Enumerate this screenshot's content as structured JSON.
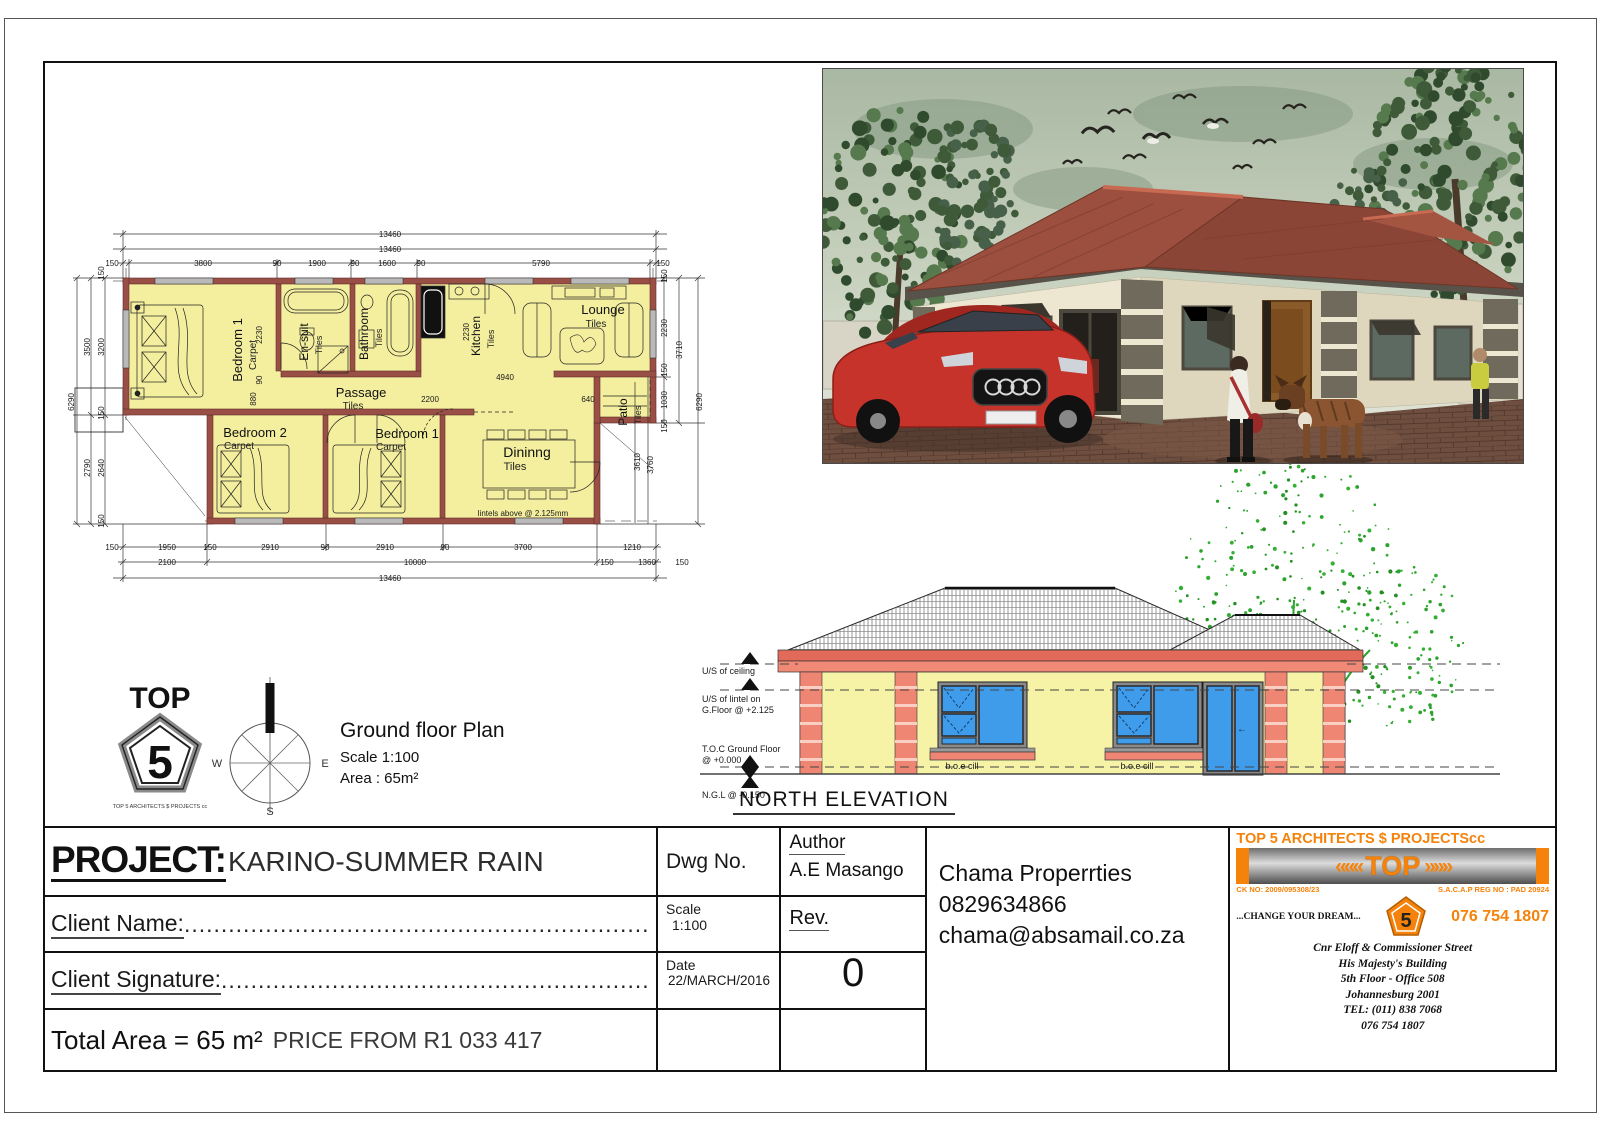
{
  "colors": {
    "accent_orange": "#F5820A",
    "plan_yellow": "#F4EF9E",
    "wall_maroon": "#9A4F46",
    "elev_salmon": "#EF8674",
    "window_blue": "#3F9CEB",
    "tree_green": "#2AA32C",
    "roof_red": "#9C4F3E"
  },
  "title_block": {
    "project_label": "PROJECT:",
    "project_name": "KARINO-SUMMER RAIN",
    "client_name_label": "Client Name:",
    "client_name_dots": "......................................................................................................",
    "client_signature_label": "Client Signature:",
    "client_signature_dots": "......................................................................................................",
    "total_area": "Total Area = 65 m²",
    "price": "PRICE FROM R1 033 417",
    "dwg_no_label": "Dwg No.",
    "author_label": "Author",
    "author_name": "A.E Masango",
    "scale_label": "Scale",
    "scale_value": "1:100",
    "rev_label": "Rev.",
    "rev_value": "0",
    "date_label": "Date",
    "date_value": "22/MARCH/2016",
    "company": "Chama Properrties",
    "phone": "0829634866",
    "email": "chama@absamail.co.za"
  },
  "architect": {
    "header": "TOP 5 ARCHITECTS $ PROJECTScc",
    "banner_text": "TOP",
    "chev_left": "«««",
    "chev_right": "»»»",
    "ck_no": "CK NO: 2009/095308/23",
    "sacap": "S.A.C.A.P REG NO : PAD 20924",
    "slogan": "...CHANGE YOUR DREAM...",
    "pentagon_number": "5",
    "phone_big": "076 754 1807",
    "address": [
      "Cnr Eloff & Commissioner Street",
      "His  Majesty's Building",
      "5th Floor - Office 508",
      "Johannesburg 2001",
      "TEL: (011) 838 7068",
      "076 754 1807"
    ]
  },
  "plan_info": {
    "logo_top": "TOP",
    "logo_number": "5",
    "logo_caption": "TOP 5 ARCHITECTS $ PROJECTS cc",
    "title": "Ground floor Plan",
    "scale": "Scale 1:100",
    "area": "Area    : 65m²",
    "compass": {
      "w": "W",
      "e": "E",
      "s": "S"
    }
  },
  "elevation": {
    "title": "NORTH ELEVATION",
    "labels": {
      "ceiling": "U/S of ceiling",
      "lintel1": "U/S of lintel on",
      "lintel2": "G.Floor @ +2.125",
      "toc1": "T.O.C Ground Floor",
      "toc2": "@ +0.000",
      "ngl": "N.G.L @ -0.150",
      "cill_left": "b.o.e cill",
      "cill_right": "b.o.e cill",
      "door_arrow": "←"
    }
  },
  "plan": {
    "note": "lintels above @ 2.125mm",
    "rooms": [
      {
        "n": "Bedroom 1",
        "f": "Carpet",
        "x": 187,
        "y": 140,
        "fx": 201,
        "fy": 145,
        "r": 1,
        "s": 13
      },
      {
        "n": "En-suit",
        "f": "Tiles",
        "x": 253,
        "y": 132,
        "fx": 267,
        "fy": 135,
        "r": 1,
        "s": 12
      },
      {
        "n": "Bathroom",
        "f": "Tiles",
        "x": 313,
        "y": 124,
        "fx": 327,
        "fy": 128,
        "r": 1,
        "s": 12
      },
      {
        "n": "Kitchen",
        "f": "Tiles",
        "x": 425,
        "y": 126,
        "fx": 439,
        "fy": 129,
        "r": 1,
        "s": 12
      },
      {
        "n": "Lounge",
        "f": "Tiles",
        "x": 548,
        "y": 104,
        "fx": 541,
        "fy": 117,
        "r": 0,
        "s": 13
      },
      {
        "n": "Passage",
        "f": "Tiles",
        "x": 306,
        "y": 187,
        "fx": 298,
        "fy": 199,
        "r": 0,
        "s": 13
      },
      {
        "n": "Bedroom 2",
        "f": "Carpet",
        "x": 200,
        "y": 227,
        "fx": 184,
        "fy": 239,
        "r": 0,
        "s": 13
      },
      {
        "n": "Bedroom 1",
        "f": "Carpet",
        "x": 352,
        "y": 228,
        "fx": 336,
        "fy": 240,
        "r": 0,
        "s": 13
      },
      {
        "n": "Dininng",
        "f": "Tiles",
        "x": 472,
        "y": 247,
        "fx": 460,
        "fy": 260,
        "r": 0,
        "s": 14
      },
      {
        "n": "Patio",
        "f": "Tiles",
        "x": 572,
        "y": 202,
        "fx": 586,
        "fy": 205,
        "r": 1,
        "s": 12
      }
    ],
    "dims": [
      {
        "t": "13460",
        "x": 335,
        "y": 27
      },
      {
        "t": "13460",
        "x": 335,
        "y": 42
      },
      {
        "t": "150",
        "x": 57,
        "y": 56
      },
      {
        "t": "3800",
        "x": 148,
        "y": 56
      },
      {
        "t": "90",
        "x": 222,
        "y": 56
      },
      {
        "t": "1900",
        "x": 262,
        "y": 56
      },
      {
        "t": "90",
        "x": 300,
        "y": 56
      },
      {
        "t": "1600",
        "x": 332,
        "y": 56
      },
      {
        "t": "90",
        "x": 366,
        "y": 56
      },
      {
        "t": "5790",
        "x": 486,
        "y": 56
      },
      {
        "t": "150",
        "x": 608,
        "y": 56
      },
      {
        "t": "150",
        "x": 49,
        "y": 63,
        "r": 1
      },
      {
        "t": "3500",
        "x": 35,
        "y": 137,
        "r": 1
      },
      {
        "t": "3200",
        "x": 49,
        "y": 137,
        "r": 1
      },
      {
        "t": "150",
        "x": 49,
        "y": 203,
        "r": 1
      },
      {
        "t": "6290",
        "x": 19,
        "y": 192,
        "r": 1
      },
      {
        "t": "2790",
        "x": 35,
        "y": 258,
        "r": 1
      },
      {
        "t": "2640",
        "x": 49,
        "y": 258,
        "r": 1
      },
      {
        "t": "150",
        "x": 49,
        "y": 311,
        "r": 1
      },
      {
        "t": "150",
        "x": 612,
        "y": 66,
        "r": 1
      },
      {
        "t": "2230",
        "x": 612,
        "y": 118,
        "r": 1
      },
      {
        "t": "150",
        "x": 612,
        "y": 160,
        "r": 1
      },
      {
        "t": "1030",
        "x": 612,
        "y": 190,
        "r": 1
      },
      {
        "t": "150",
        "x": 612,
        "y": 216,
        "r": 1
      },
      {
        "t": "3710",
        "x": 627,
        "y": 140,
        "r": 1
      },
      {
        "t": "6290",
        "x": 647,
        "y": 192,
        "r": 1
      },
      {
        "t": "3610",
        "x": 585,
        "y": 252,
        "r": 1
      },
      {
        "t": "3760",
        "x": 598,
        "y": 255,
        "r": 1
      },
      {
        "t": "150",
        "x": 57,
        "y": 340
      },
      {
        "t": "1950",
        "x": 112,
        "y": 340
      },
      {
        "t": "150",
        "x": 155,
        "y": 340
      },
      {
        "t": "2910",
        "x": 215,
        "y": 340
      },
      {
        "t": "90",
        "x": 270,
        "y": 340
      },
      {
        "t": "2910",
        "x": 330,
        "y": 340
      },
      {
        "t": "90",
        "x": 390,
        "y": 340
      },
      {
        "t": "3700",
        "x": 468,
        "y": 340
      },
      {
        "t": "1210",
        "x": 577,
        "y": 340
      },
      {
        "t": "2100",
        "x": 112,
        "y": 355
      },
      {
        "t": "10000",
        "x": 360,
        "y": 355
      },
      {
        "t": "150",
        "x": 552,
        "y": 355
      },
      {
        "t": "1360",
        "x": 592,
        "y": 355
      },
      {
        "t": "150",
        "x": 627,
        "y": 355
      },
      {
        "t": "13460",
        "x": 335,
        "y": 371
      },
      {
        "t": "2230",
        "x": 207,
        "y": 125,
        "r": 1
      },
      {
        "t": "90",
        "x": 207,
        "y": 170,
        "r": 1
      },
      {
        "t": "880",
        "x": 201,
        "y": 189,
        "r": 1
      },
      {
        "t": "4940",
        "x": 450,
        "y": 170
      },
      {
        "t": "2200",
        "x": 375,
        "y": 192
      },
      {
        "t": "640",
        "x": 533,
        "y": 192
      },
      {
        "t": "2230",
        "x": 414,
        "y": 122,
        "r": 1
      }
    ]
  }
}
